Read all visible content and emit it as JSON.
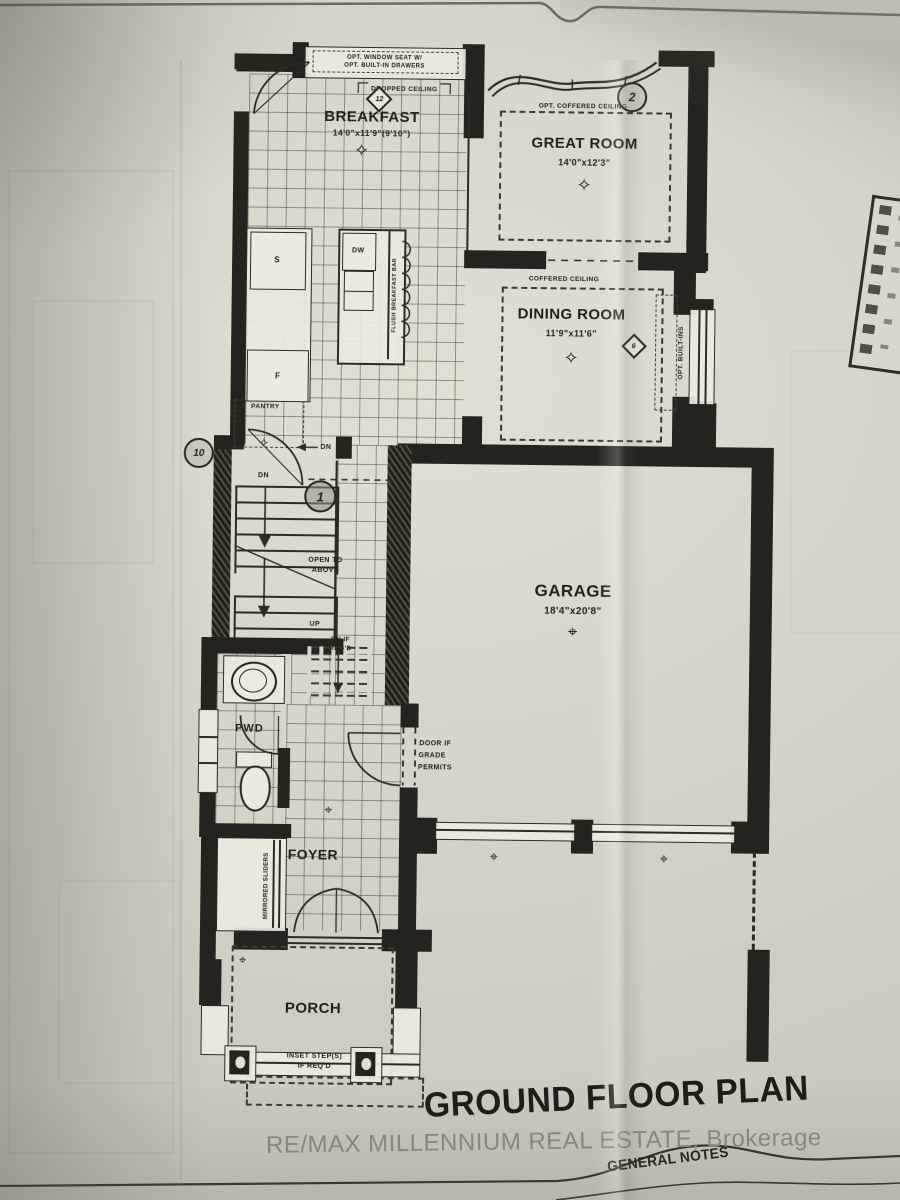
{
  "plan": {
    "title": "GROUND FLOOR PLAN",
    "watermark": "RE/MAX MILLENNIUM REAL ESTATE, Brokerage",
    "general_notes": "GENERAL NOTES",
    "symbols": {
      "star": "✧",
      "target": "⌖"
    },
    "rooms": {
      "breakfast": {
        "name": "BREAKFAST",
        "dims": "14'0\"x11'9\"(9'10\")"
      },
      "great_room": {
        "name": "GREAT ROOM",
        "dims": "14'0\"x12'3\""
      },
      "dining_room": {
        "name": "DINING ROOM",
        "dims": "11'9\"x11'6\""
      },
      "garage": {
        "name": "GARAGE",
        "dims": "18'4\"x20'8\""
      },
      "pwd": {
        "name": "PWD"
      },
      "foyer": {
        "name": "FOYER"
      },
      "porch": {
        "name": "PORCH"
      }
    },
    "annotations": {
      "window_seat_1": "OPT. WINDOW SEAT W/",
      "window_seat_2": "OPT. BUILT-IN DRAWERS",
      "dropped_ceiling": "DROPPED CEILING",
      "opt_coffered_ceiling": "OPT. COFFERED CEILING",
      "coffered_ceiling": "COFFERED CEILING",
      "opt_builtins": "OPT. BUILT-INS",
      "flush_breakfast_bar": "FLUSH BREAKFAST BAR",
      "pantry": "PANTRY",
      "dishwasher": "DW",
      "sink": "S",
      "fridge": "F",
      "dn_top": "DN",
      "dn_stair": "DN",
      "up": "UP",
      "dn_if_1": "DN IF",
      "dn_if_2": "REQ'D",
      "open_above_1": "OPEN TO",
      "open_above_2": "ABOVE",
      "door_grade_1": "DOOR IF",
      "door_grade_2": "GRADE",
      "door_grade_3": "PERMITS",
      "mirrored_sliders": "MIRRORED SLIDERS",
      "inset_1": "INSET STEP(S)",
      "inset_2": "IF REQ'D"
    },
    "markers": {
      "m12": "12",
      "m2": "2",
      "m10": "10",
      "m1": "1",
      "m6": "6"
    }
  }
}
